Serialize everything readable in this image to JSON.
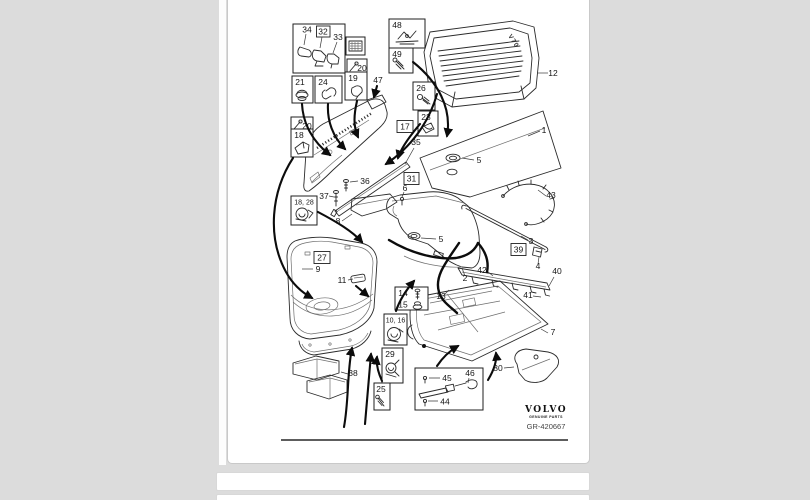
{
  "page": {
    "footer": {
      "brand": "VOLVO",
      "brand_sub": "GENUINE PARTS",
      "drawing_code": "GR-420667"
    },
    "diagram": {
      "model_label": "V70"
    }
  },
  "labels": {
    "p1": "1",
    "p2": "2",
    "p3": "3",
    "p4": "4",
    "p5a": "5",
    "p5b": "5",
    "p6": "6",
    "p7": "7",
    "p8": "8",
    "p9": "9",
    "p10_16": "10, 16",
    "p11": "11",
    "p12": "12",
    "p13": "13",
    "p14": "14",
    "p15": "15",
    "p17": "17",
    "p18": "18",
    "p18_28": "18, 28",
    "p19": "19",
    "p20a": "20",
    "p20b": "20",
    "p21": "21",
    "p23": "23",
    "p24": "24",
    "p25": "25",
    "p26": "26",
    "p27": "27",
    "p29": "29",
    "p30": "30",
    "p31": "31",
    "p32": "32",
    "p33": "33",
    "p34": "34",
    "p35": "35",
    "p36": "36",
    "p37": "37",
    "p38": "38",
    "p39": "39",
    "p40": "40",
    "p41": "41",
    "p42": "42",
    "p43": "43",
    "p44": "44",
    "p45": "45",
    "p46": "46",
    "p47": "47",
    "p48": "48",
    "p49": "49"
  }
}
